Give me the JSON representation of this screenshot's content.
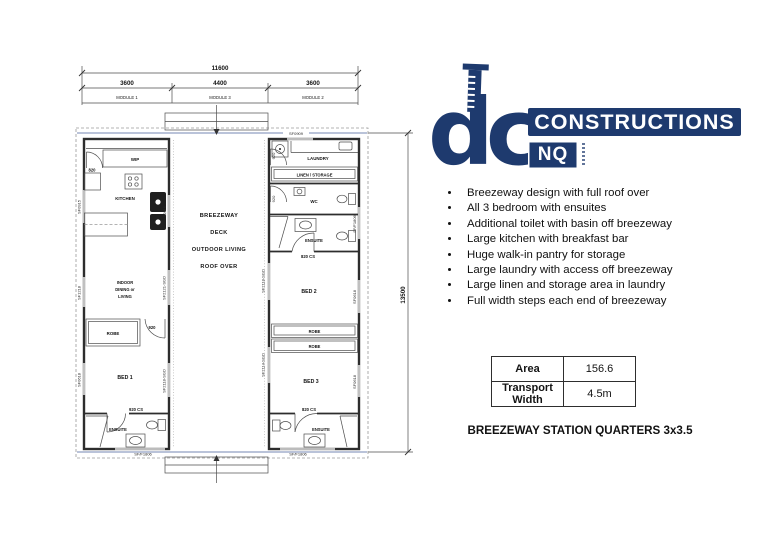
{
  "logo": {
    "dc": "dc",
    "constructions": "CONSTRUCTIONS",
    "nq": "NQ",
    "navy": "#1e3a6e"
  },
  "features": {
    "items": [
      "Breezeway design with full roof over",
      "All 3 bedroom with ensuites",
      "Additional toilet with basin off breezeway",
      "Large kitchen with breakfast bar",
      "Huge walk-in pantry for storage",
      "Large laundry with access off breezeway",
      "Large linen and storage area in laundry",
      "Full width steps each end of breezeway"
    ]
  },
  "spec_table": {
    "rows": [
      {
        "label": "Area",
        "value": "156.6"
      },
      {
        "label": "Transport Width",
        "value": "4.5m"
      }
    ]
  },
  "title": {
    "text": "BREEZEWAY STATION QUARTERS 3x3.5"
  },
  "plan": {
    "dims": {
      "total": "11600",
      "m1": "3600",
      "m3": "4400",
      "m2": "3600",
      "height": "13500"
    },
    "modules": [
      "MODULE 1",
      "MODULE 3",
      "MODULE 2"
    ],
    "breezeway": [
      "BREEZEWAY",
      "DECK",
      "OUTDOOR LIVING",
      "ROOF OVER"
    ],
    "m1": {
      "wip": "WIP",
      "wip_door": "820",
      "kitchen": "KITCHEN",
      "living": [
        "INDOOR",
        "DINING or",
        "LIVING"
      ],
      "robe": "ROBE",
      "robe_door": "920",
      "bed": "BED 1",
      "ens_door": "920 CS",
      "ensuite": "ENSUITE",
      "bottom_window": "SF/F1806",
      "left_windows": [
        "SF0915",
        "SF1218",
        "SF0618"
      ],
      "right_windows": [
        "SF0915",
        "SF2121-SGD",
        "SF2118-SGD"
      ]
    },
    "m2": {
      "top_window": "SF0909",
      "laundry": "LAUNDRY",
      "laundry_door": "920",
      "linen": "LINEN / STORAGE",
      "wc": "WC",
      "wc_door": "920",
      "ensuite_top": "ENSUITE",
      "ens_top_door": "820 CS",
      "bed2": "BED 2",
      "robe1": "ROBE",
      "robe2": "ROBE",
      "bed3": "BED 3",
      "ens_bot_door": "820 CS",
      "ensuite_bot": "ENSUITE",
      "bottom_window": "SF/F1806",
      "left_windows": [
        "SF2118-SGD",
        "SF2114-SGD"
      ],
      "right_windows": [
        "SF/F1806",
        "SF0618",
        "SF0618"
      ]
    }
  }
}
